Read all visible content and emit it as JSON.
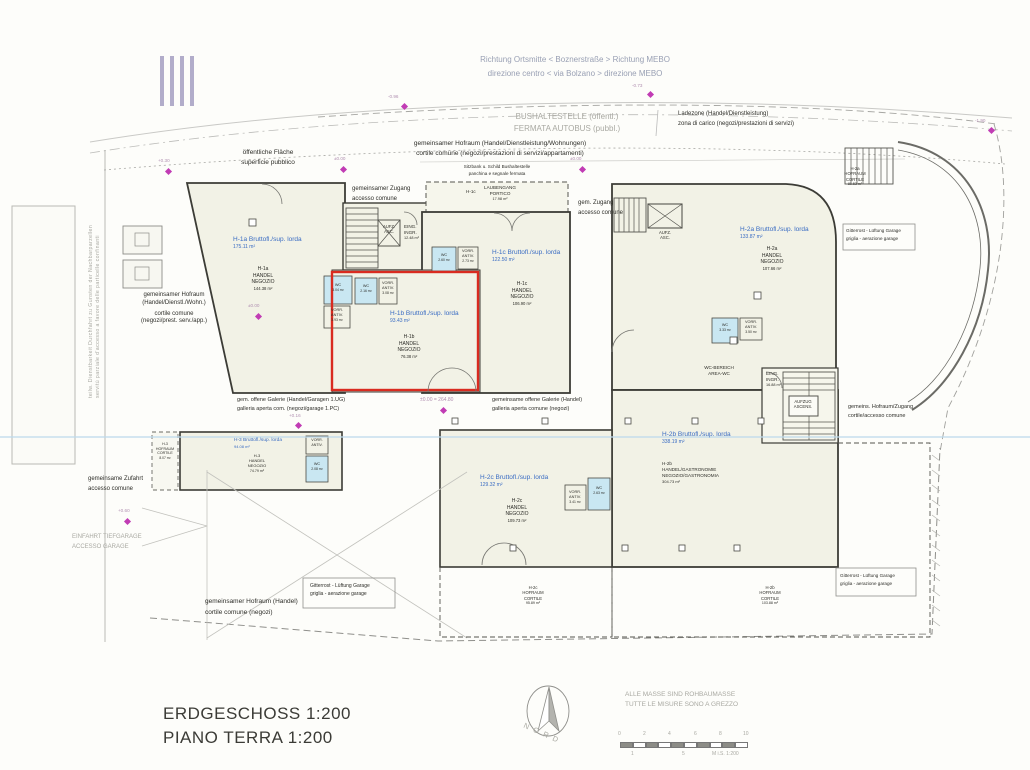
{
  "plan": {
    "title_de": "ERDGESCHOSS  1:200",
    "title_it": "PIANO TERRA  1:200",
    "note_de": "ALLE MASSE SIND ROHBAUMASSE",
    "note_it": "TUTTE LE MISURE SONO A GREZZO",
    "north_label": "NORD",
    "scale_label": "M i.S. 1:200"
  },
  "scalebar": {
    "t0": "0",
    "t1": "2",
    "t2": "4",
    "t3": "6",
    "t4": "8",
    "t5": "10",
    "b1": "1",
    "b2": "5"
  },
  "street": {
    "direction_de": "Richtung Ortsmitte  <  Boznerstraße  >  Richtung MEBO",
    "direction_it": "direzione centro  <  via Bolzano  >  direzione MEBO",
    "busstop_de": "BUSHALTESTELLE (öffentl.)",
    "busstop_it": "FERMATA AUTOBUS (pubbl.)",
    "ladezone_de": "Ladezone (Handel/Dienstleistung)",
    "ladezone_it": "zona di carico (negozi/prestazioni di servizi)"
  },
  "site": {
    "hofraum_top_de": "gemeinsamer Hofraum (Handel/Dienstleistung/Wohnungen)",
    "hofraum_top_it": "cortile comune (negozi/prestazioni di servizi/appartamenti)",
    "sitzbank_de": "Sitzbank u. Schild Bushaltestelle",
    "sitzbank_it": "panchina e segnale fermata",
    "public_de": "öffentliche Fläche",
    "public_it": "superficie pubblico",
    "zugang1_de": "gemeinsamer Zugang",
    "zugang1_it": "accesso comune",
    "zugang2_de": "gem. Zugang",
    "zugang2_it": "accesso comune",
    "hofraum_left_de": "gemeinsamer Hofraum",
    "hofraum_left_de2": "(Handel/Dienstl./Wohn.)",
    "hofraum_left_it": "cortile comune",
    "hofraum_left_it2": "(negozi/prest. serv./app.)",
    "galerie1_de": "gem. offene Galerie (Handel/Garagen 1.UG)",
    "galerie1_it": "galleria aperta com. (negozi/garage 1.PC)",
    "galerie2_de": "gemeinsame offene Galerie (Handel)",
    "galerie2_it": "galleria aperta comune (negozi)",
    "zufahrt_de": "gemeinsame Zufahrt",
    "zufahrt_it": "accesso comune",
    "einfahrt_de": "EINFAHRT  TIEFGARAGE",
    "einfahrt_it": "ACCESSO  GARAGE",
    "hofraum_bottom_de": "gemeinsamer Hofraum (Handel)",
    "hofraum_bottom_it": "cortile comune (negozi)",
    "gitterrost_de": "Gitterrost - Lüftung Garage",
    "gitterrost_it": "griglia - aerazione garage",
    "hofzugang_de": "gemeins. Hofraum/Zugang",
    "hofzugang_it": "cortile/accesso comune",
    "servitude_de": "teilw. Dienstbarkeit Durchfahrt zu Gunsten der Nachbarparzellen",
    "servitude_it": "servitù parziale d'accesso a favore delle particelle confinanti",
    "datum": "±0.00 = 264.80"
  },
  "markers": {
    "m1": "+0.30",
    "m2": "±0.00",
    "m3": "±0.00",
    "m4": "±0.00",
    "m5": "-0.73",
    "m6": "-0.96",
    "m7": "-1.90",
    "m8": "+0.16",
    "m9": "+0.60"
  },
  "units": {
    "h1a": {
      "gross": "H-1a Bruttofl./sup. lorda",
      "gross_area": "175.11 m²",
      "code": "H-1a",
      "use1": "HANDEL",
      "use2": "NEGOZIO",
      "net_area": "144.38 m²"
    },
    "h1b": {
      "gross": "H-1b Bruttofl./sup. lorda",
      "gross_area": "93.43 m²",
      "code": "H-1b",
      "use1": "HANDEL",
      "use2": "NEGOZIO",
      "net_area": "76.38 m²"
    },
    "h1c": {
      "gross": "H-1c Bruttofl./sup. lorda",
      "gross_area": "122.50 m²",
      "code": "H-1c",
      "use1": "HANDEL",
      "use2": "NEGOZIO",
      "net_area": "106.90 m²"
    },
    "h2a": {
      "gross": "H-2a Bruttofl./sup. lorda",
      "gross_area": "133.87 m²",
      "code": "H-2a",
      "use1": "HANDEL",
      "use2": "NEGOZIO",
      "net_area": "107.66 m²"
    },
    "h2b": {
      "gross": "H-2b Bruttofl./sup. lorda",
      "gross_area": "338.19 m²",
      "code": "H-2b",
      "use1": "HANDEL/GASTRONOMIE",
      "use2": "NEGOZIO/GASTRONOMIA",
      "net_area": "304.73 m²"
    },
    "h2c": {
      "gross": "H-2c Bruttofl./sup. lorda",
      "gross_area": "129.32 m²",
      "code": "H-2c",
      "use1": "HANDEL",
      "use2": "NEGOZIO",
      "net_area": "109.73 m²"
    },
    "h3": {
      "gross": "H-3 Bruttofl./sup. lorda",
      "gross_area": "94.08 m²",
      "code": "H-3",
      "use1": "HANDEL",
      "use2": "NEGOZIO",
      "net_area": "74.79 m²"
    }
  },
  "courtyards": {
    "h2a": {
      "code": "H-2a",
      "l1": "HOFRAUM",
      "l2": "CORTILE",
      "area": "81.53 m²"
    },
    "h2b": {
      "code": "H-2b",
      "l1": "HOFRAUM",
      "l2": "CORTILE",
      "area": "103.88 m²"
    },
    "h2c": {
      "code": "H-2c",
      "l1": "HOFRAUM",
      "l2": "CORTILE",
      "area": "95.89 m²"
    },
    "h3": {
      "code": "H-3",
      "l1": "HOFRAUM",
      "l2": "CORTILE",
      "area": "8.07 m²"
    }
  },
  "rooms": {
    "wc_h1a": {
      "name": "WC",
      "area": "3.04 m²"
    },
    "wc_h1b": {
      "name": "WC",
      "area": "2.16 m²"
    },
    "wc_h1c": {
      "name": "WC",
      "area": "2.60 m²"
    },
    "wc_h2a": {
      "name": "WC",
      "area": "3.33 m²"
    },
    "wc_h2c": {
      "name": "WC",
      "area": "2.63 m²"
    },
    "wc_h3": {
      "name": "WC",
      "area": "2.08 m²"
    },
    "vorr_h1a": {
      "l1": "VORR.",
      "l2": "ANTIV.",
      "area": "3.93 m²"
    },
    "vorr_h1b": {
      "l1": "VORR.",
      "l2": "ANTIV.",
      "area": "3.08 m²"
    },
    "vorr_h1c": {
      "l1": "VORR.",
      "l2": "ANTIV.",
      "area": "2.73 m²"
    },
    "vorr_h2a": {
      "l1": "VORR.",
      "l2": "ANTIV.",
      "area": "3.50 m²"
    },
    "vorr_h2c": {
      "l1": "VORR.",
      "l2": "ANTIV.",
      "area": "3.41 m²"
    },
    "vorr_h3": {
      "l1": "VORR.",
      "l2": "ANTIV."
    }
  },
  "cores": {
    "aufz": {
      "l1": "AUFZ.",
      "l2": "ASC."
    },
    "eing1": {
      "l1": "EING.",
      "l2": "INGR.",
      "area": "12.48 m²"
    },
    "eing2": {
      "l1": "EING.",
      "l2": "INGR.",
      "area": "16.88 m²"
    },
    "aufzug": {
      "l1": "AUFZUG",
      "l2": "ASCENS."
    },
    "wcbereich": {
      "l1": "WC-BEREICH",
      "l2": "AREA-WC"
    },
    "laubengang": {
      "code": "H-1c",
      "l1": "LAUBENGANG",
      "l2": "PORTICO",
      "area": "17.98 m²"
    }
  }
}
